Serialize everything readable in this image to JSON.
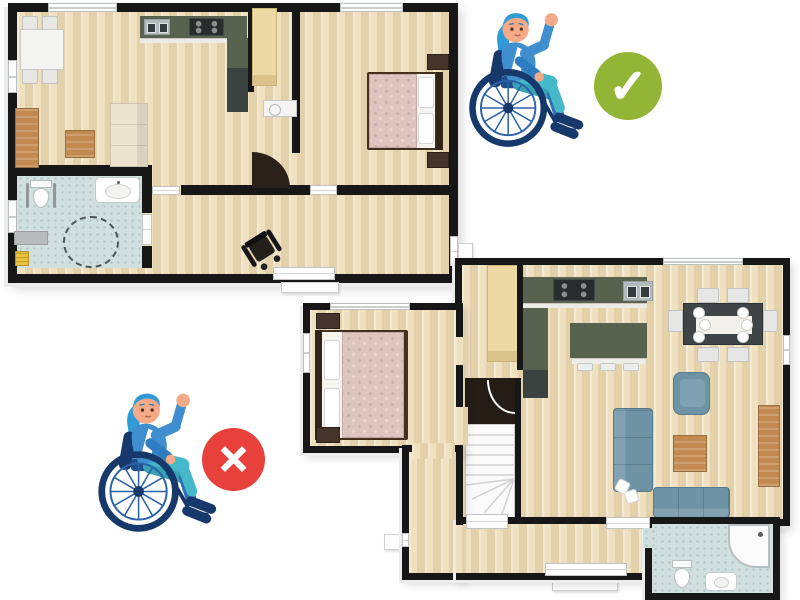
{
  "scene": {
    "type": "floor-plan-accessibility-comparison",
    "background": "#ffffff"
  },
  "marks": {
    "approved": {
      "shape": "circle",
      "glyph": "✓",
      "color_key": "ok-green"
    },
    "rejected": {
      "shape": "circle",
      "glyph": "✕",
      "color_key": "error-red"
    }
  },
  "plans": {
    "accessible": {
      "name": "single-level-accessible-floor-plan",
      "verdict": "approved",
      "rooms": [
        "dining-area",
        "kitchen",
        "living-area",
        "pantry",
        "bedroom",
        "accessible-bathroom",
        "hallway"
      ],
      "features": [
        "wheelchair-turning-circle",
        "toilet-grab-bars",
        "wheelchair-in-hallway",
        "wide-doorways"
      ]
    },
    "two_story": {
      "name": "two-story-floor-plan-with-stairs",
      "verdict": "rejected",
      "rooms": [
        "kitchen",
        "dining-area",
        "living-area",
        "bedroom",
        "bathroom",
        "entry-hall",
        "staircase"
      ],
      "features": [
        "winder-staircase",
        "kitchen-island",
        "corner-shower"
      ]
    }
  },
  "colors": {
    "wall": "#171717",
    "counter": "#57634f",
    "appliance-dark": "#272d2c",
    "fridge": "#3a4340",
    "wood-furniture": "#c28a50",
    "sofa-blue": "#6e93a5",
    "sofa-cream": "#ece3d0",
    "bed-duvet": "#dcc5bf",
    "bed-frame": "#43301f",
    "wardrobe": "#ecd9a4",
    "ok-green": "#93b535",
    "error-red": "#e8413b",
    "wc-navy": "#16386b",
    "wc-blue": "#2b62a8",
    "jacket": "#3f8ed0",
    "jacket-dark": "#2f7cc0",
    "hair": "#2f9cd8",
    "skin": "#f4a987",
    "pants": "#45b8c9",
    "pants-dark": "#2f6fb0",
    "seat": "#1d4f8c"
  }
}
